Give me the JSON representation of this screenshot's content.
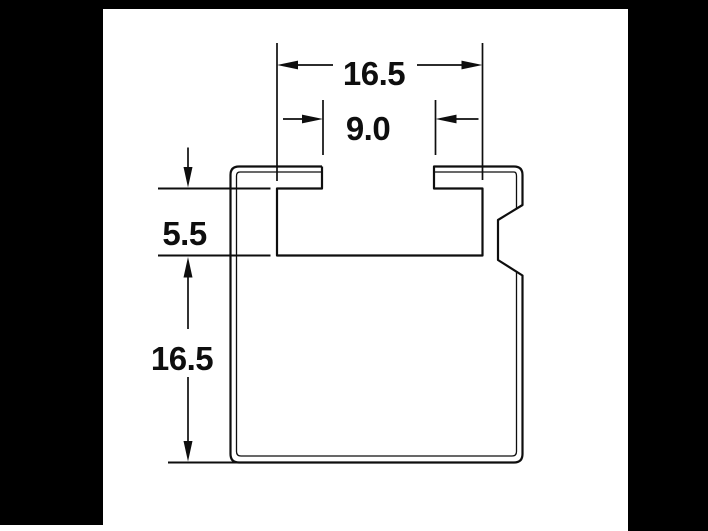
{
  "colors": {
    "background": "#000000",
    "page": "#ffffff",
    "line": "#0e0e0e"
  },
  "dimensions": {
    "slot_width": {
      "label": "16.5"
    },
    "throat_width": {
      "label": "9.0"
    },
    "slot_depth": {
      "label": "5.5"
    },
    "body_height": {
      "label": "16.5"
    }
  }
}
